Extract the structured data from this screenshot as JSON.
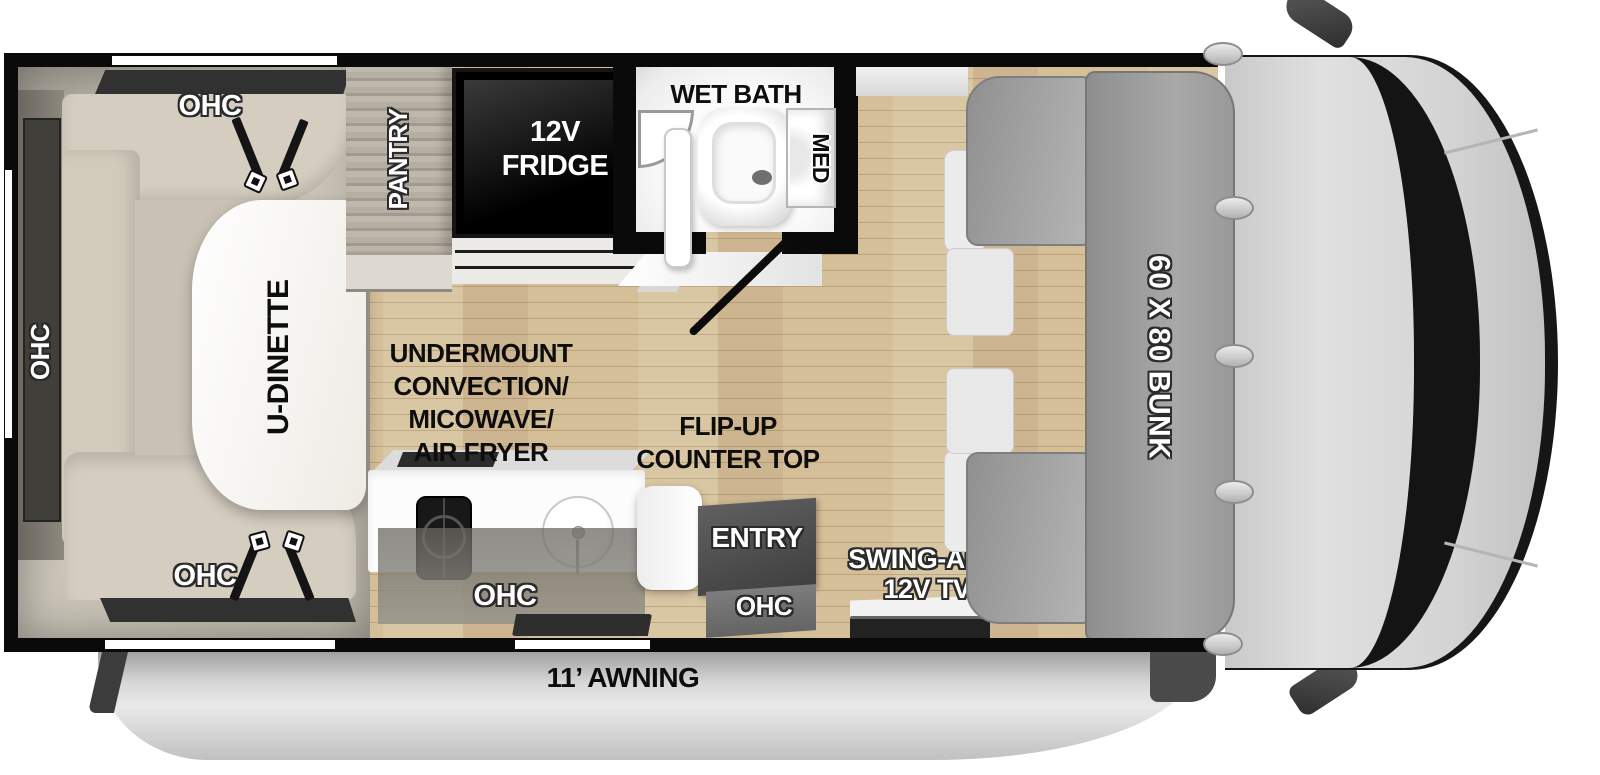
{
  "plan": {
    "dinette": {
      "table_label": "U-DINETTE",
      "ohc_top": "OHC",
      "ohc_left": "OHC",
      "ohc_bottom": "OHC"
    },
    "galley": {
      "pantry_label": "PANTRY",
      "fridge_lines": [
        "12V",
        "FRIDGE"
      ],
      "appliance_lines": [
        "UNDERMOUNT",
        "CONVECTION/",
        "MICOWAVE/",
        "AIR FRYER"
      ],
      "flip_counter_lines": [
        "FLIP-UP",
        "COUNTER TOP"
      ],
      "ohc_label": "OHC"
    },
    "bath": {
      "title": "WET BATH",
      "med_cabinet": "MED"
    },
    "entry": {
      "door_label": "ENTRY",
      "ohc_label": "OHC"
    },
    "tv_lines": [
      "SWING-ARM",
      "12V TV"
    ],
    "bunk_label": "60 X 80 BUNK",
    "awning_label": "11’ AWNING"
  },
  "colors": {
    "wall_black": "#0a0a0a",
    "wood_floor": "#d5bf99",
    "bench_beige": "#d5cec0",
    "bunk_gray": "#9a9a9a",
    "cab_gray": "#d2d2d2",
    "awning_gray": "#c9c9c9",
    "fridge_black": "#000000"
  }
}
